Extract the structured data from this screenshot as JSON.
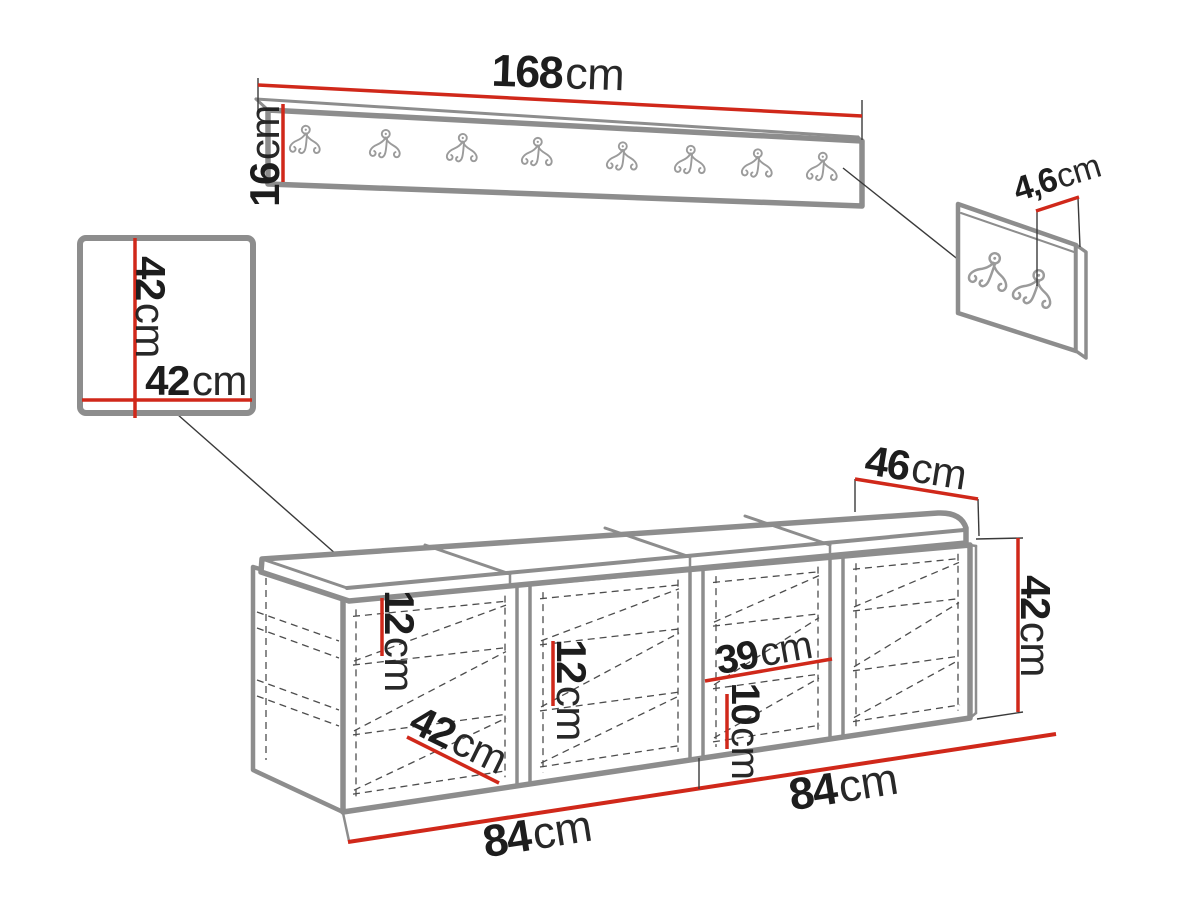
{
  "diagram": {
    "title": "hallway-furniture-set-dimension-drawing",
    "colors": {
      "dimension_red": "#d0281a",
      "furniture_gray": "#8d8d8d",
      "hidden_line_gray": "#4d4d4d",
      "text_black": "#1d1d1d",
      "hook_gray": "#9b9b9b"
    },
    "icons": {
      "coat_hook": "double-coat-hook-icon"
    },
    "hook_counts": {
      "rack": 8,
      "panel": 2
    },
    "labels": {
      "rack_width": {
        "value": "168",
        "unit": "cm"
      },
      "rack_height": {
        "value": "16",
        "unit": "cm"
      },
      "hook_panel_depth": {
        "value": "4,6",
        "unit": "cm"
      },
      "square_height": {
        "value": "42",
        "unit": "cm"
      },
      "square_width": {
        "value": "42",
        "unit": "cm"
      },
      "bench_depth": {
        "value": "46",
        "unit": "cm"
      },
      "bench_height": {
        "value": "42",
        "unit": "cm"
      },
      "shelf_gap_top": {
        "value": "12",
        "unit": "cm"
      },
      "shelf_gap_middle": {
        "value": "12",
        "unit": "cm"
      },
      "compartment_width": {
        "value": "39",
        "unit": "cm"
      },
      "shelf_gap_bottom": {
        "value": "10",
        "unit": "cm"
      },
      "bench_inner_depth": {
        "value": "42",
        "unit": "cm"
      },
      "bench_half_left": {
        "value": "84",
        "unit": "cm"
      },
      "bench_half_right": {
        "value": "84",
        "unit": "cm"
      }
    }
  }
}
